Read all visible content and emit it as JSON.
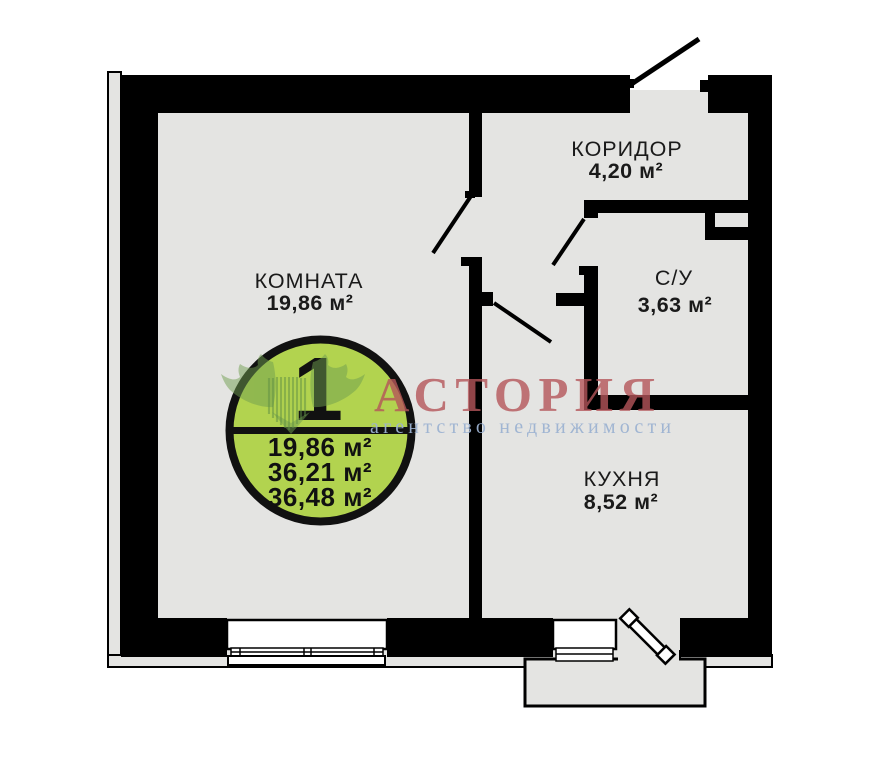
{
  "floorplan": {
    "rooms": [
      {
        "name": "КОМНАТА",
        "area": "19,86 м²"
      },
      {
        "name": "КОРИДОР",
        "area": "4,20 м²"
      },
      {
        "name": "С/У",
        "area": "3,63 м²"
      },
      {
        "name": "КУХНЯ",
        "area": "8,52 м²"
      }
    ],
    "badge": {
      "rooms_count": "1",
      "areas": [
        "19,86 м²",
        "36,21 м²",
        "36,48 м²"
      ]
    },
    "watermark": {
      "brand": "АСТОРИЯ",
      "tagline": "агентство недвижимости"
    },
    "colors": {
      "wall": "#000000",
      "floor": "#e4e4e2",
      "badge_fill": "#b2d34f",
      "brand_text": "#b5565a",
      "tagline_text": "#9db3d2",
      "logo_green": "#6f9e4f"
    }
  }
}
